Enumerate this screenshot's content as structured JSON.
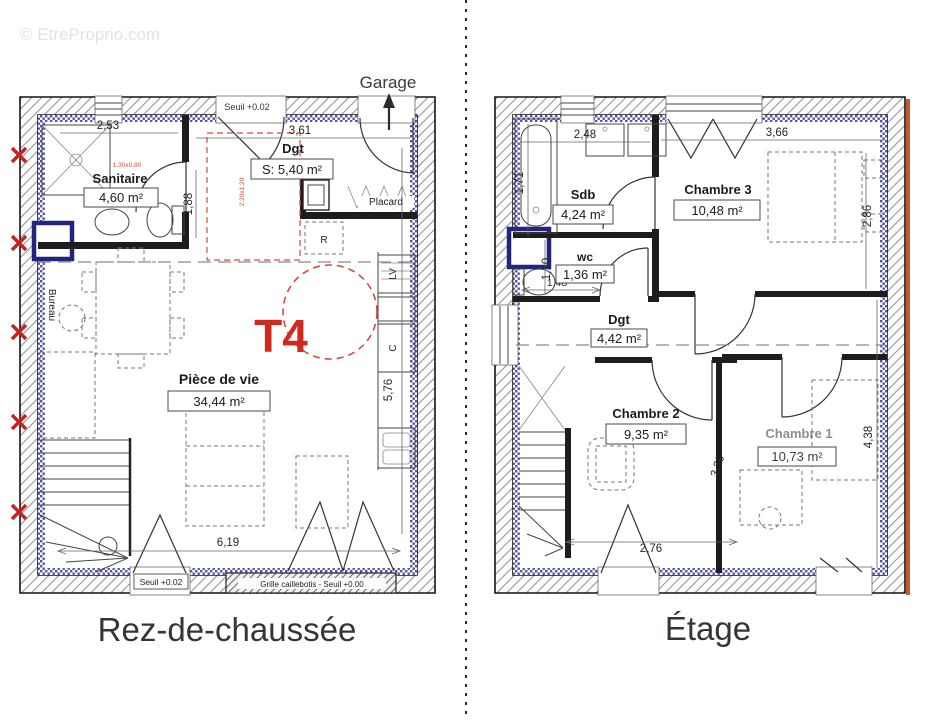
{
  "watermark": "© EtreProprio.com",
  "colors": {
    "type_red": "#d02a20",
    "insulation_blue": "#5353ab",
    "window_navy": "#24247e",
    "roof_orange": "#c05a32",
    "red_marks": "#c52222",
    "caption_text": "#32353a"
  },
  "gf": {
    "caption": "Rez-de-chaussée",
    "garage": "Garage",
    "seuil_top": "Seuil +0.02",
    "seuil_bottom": "Seuil +0.02",
    "grille": "Grille caillebotis - Seuil +0.00",
    "type_label": "T4",
    "rooms": {
      "sanitaire": {
        "name": "Sanitaire",
        "area": "4,60 m²"
      },
      "dgt": {
        "name": "Dgt",
        "area": "S: 5,40 m²"
      },
      "piece_de_vie": {
        "name": "Pièce de vie",
        "area": "34,44 m²"
      },
      "placard": {
        "name": "Placard"
      },
      "bureau": {
        "name": "Bureau"
      }
    },
    "appliances": {
      "fridge": "R",
      "dishwasher": "LV",
      "cooker": "C"
    },
    "dims": {
      "sanitaire_w": "2,53",
      "entry_w": "3,61",
      "sanitaire_h": "1,88",
      "kitchen_h": "5,76",
      "living_w": "6,19"
    },
    "red_notes": {
      "shower": "1.30x0.80",
      "dgt": "2.20x1.20"
    }
  },
  "et": {
    "caption": "Étage",
    "rooms": {
      "sdb": {
        "name": "Sdb",
        "area": "4,24 m²"
      },
      "wc": {
        "name": "wc",
        "area": "1,36 m²"
      },
      "dgt": {
        "name": "Dgt",
        "area": "4,42 m²"
      },
      "chambre1": {
        "name": "Chambre 1",
        "area": "10,73 m²"
      },
      "chambre2": {
        "name": "Chambre 2",
        "area": "9,35 m²"
      },
      "chambre3": {
        "name": "Chambre 3",
        "area": "10,48 m²"
      }
    },
    "dims": {
      "sdb_w": "2,48",
      "ch3_w": "3,66",
      "bath_h": "1,71",
      "ch3_h": "2,86",
      "wc_h": "1,10",
      "wc_w": "1,48",
      "ch2_diag": "3,39",
      "ch1_h": "4,38",
      "ch2_w": "2,76"
    }
  }
}
